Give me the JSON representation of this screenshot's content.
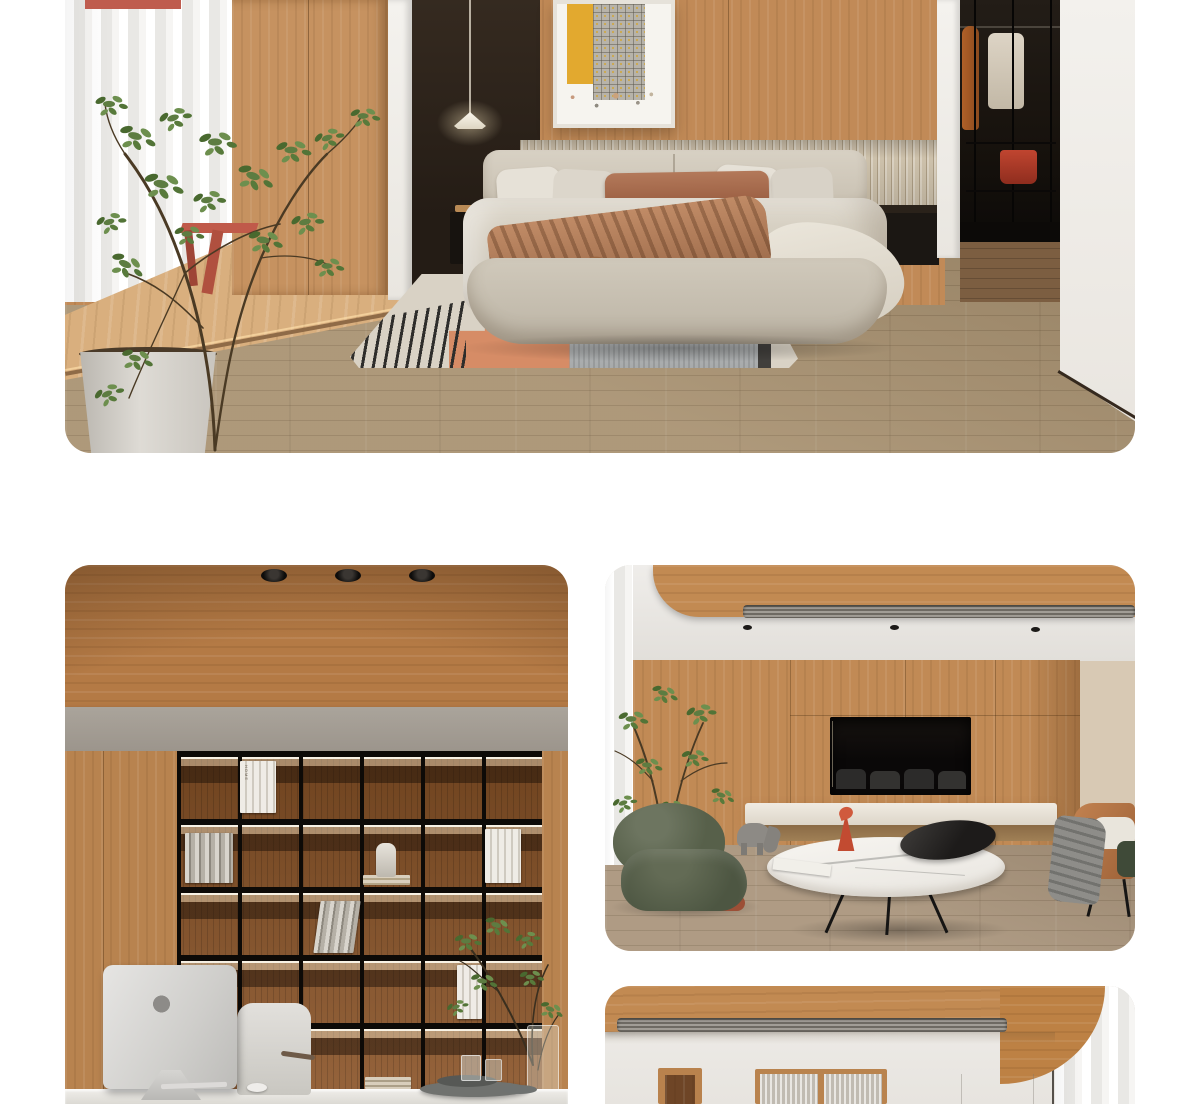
{
  "page": {
    "background": "#ffffff",
    "kind": "product-detail image gallery (interior renders)"
  },
  "gallery": [
    {
      "id": "bedroom",
      "description": "Wood-panelled bedroom: upholstered beige bed, abstract framed artwork, pendant lamp on dark wall, green tree with white planter, terracotta side table, striped area rug, walk-in closet with hanging clothes, oak plank flooring"
    },
    {
      "id": "study",
      "description": "Home office: wood slab ceiling with three recessed spotlights, grey beam, black grid bookshelf with LED-lit wooden cells, books and figurine, silver iMac seen from behind on a white desk with chair, tray and branch vase"
    },
    {
      "id": "living-room",
      "description": "Living room: curved wood ceiling with linear air vent, wood media wall with dark recessed niche, stone ledge, olive-green lounge chair, elephant figure, oval marble coffee table with black dish and red sculpture, tan leather armchair with grey throw, oak flooring"
    },
    {
      "id": "hallway",
      "description": "Dining hall fragment: curved wood plank ceiling with linear diffuser, white walls, wood doorway, fluted-glass display cabinet, sheer grey curtains"
    }
  ],
  "study": {
    "book_spine_label": "HOME"
  },
  "palette": {
    "wood_wall": "#c18a57",
    "wood_ceiling": "#bb8049",
    "floor_oak": "#a7906f",
    "dark_wall": "#2e2419",
    "beam_gray": "#a49d94",
    "accent_terracotta": "#c05a4a",
    "accent_orange_rug": "#d68c66",
    "accent_olive_chair": "#57604a",
    "accent_red_bag": "#b13826",
    "page_white": "#ffffff"
  }
}
